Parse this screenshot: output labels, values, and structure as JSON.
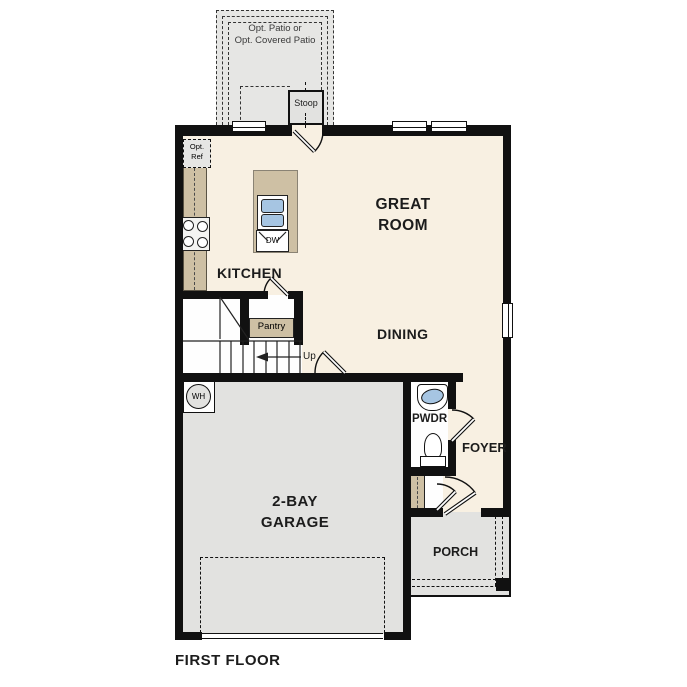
{
  "colors": {
    "floor": "#f8f0e2",
    "room_white": "#fefefe",
    "hardscape": "#e2e2e0",
    "patio": "#e6e6e4",
    "casework": "#cec0a4",
    "fixture_blue": "#a6c5e2",
    "wall": "#111111",
    "line": "#222222",
    "text": "#1c1c1c",
    "muted_text": "#3a3a3a"
  },
  "labels": {
    "patio_line1": "Opt. Patio or",
    "patio_line2": "Opt. Covered Patio",
    "stoop": "Stoop",
    "opt_ref_line1": "Opt.",
    "opt_ref_line2": "Ref",
    "kitchen": "KITCHEN",
    "great_room_line1": "GREAT",
    "great_room_line2": "ROOM",
    "dining": "DINING",
    "pantry": "Pantry",
    "up": "Up",
    "wh": "WH",
    "dw": "DW",
    "garage_line1": "2-BAY",
    "garage_line2": "GARAGE",
    "pwdr": "PWDR",
    "foyer": "FOYER",
    "porch": "PORCH",
    "title": "FIRST FLOOR"
  }
}
